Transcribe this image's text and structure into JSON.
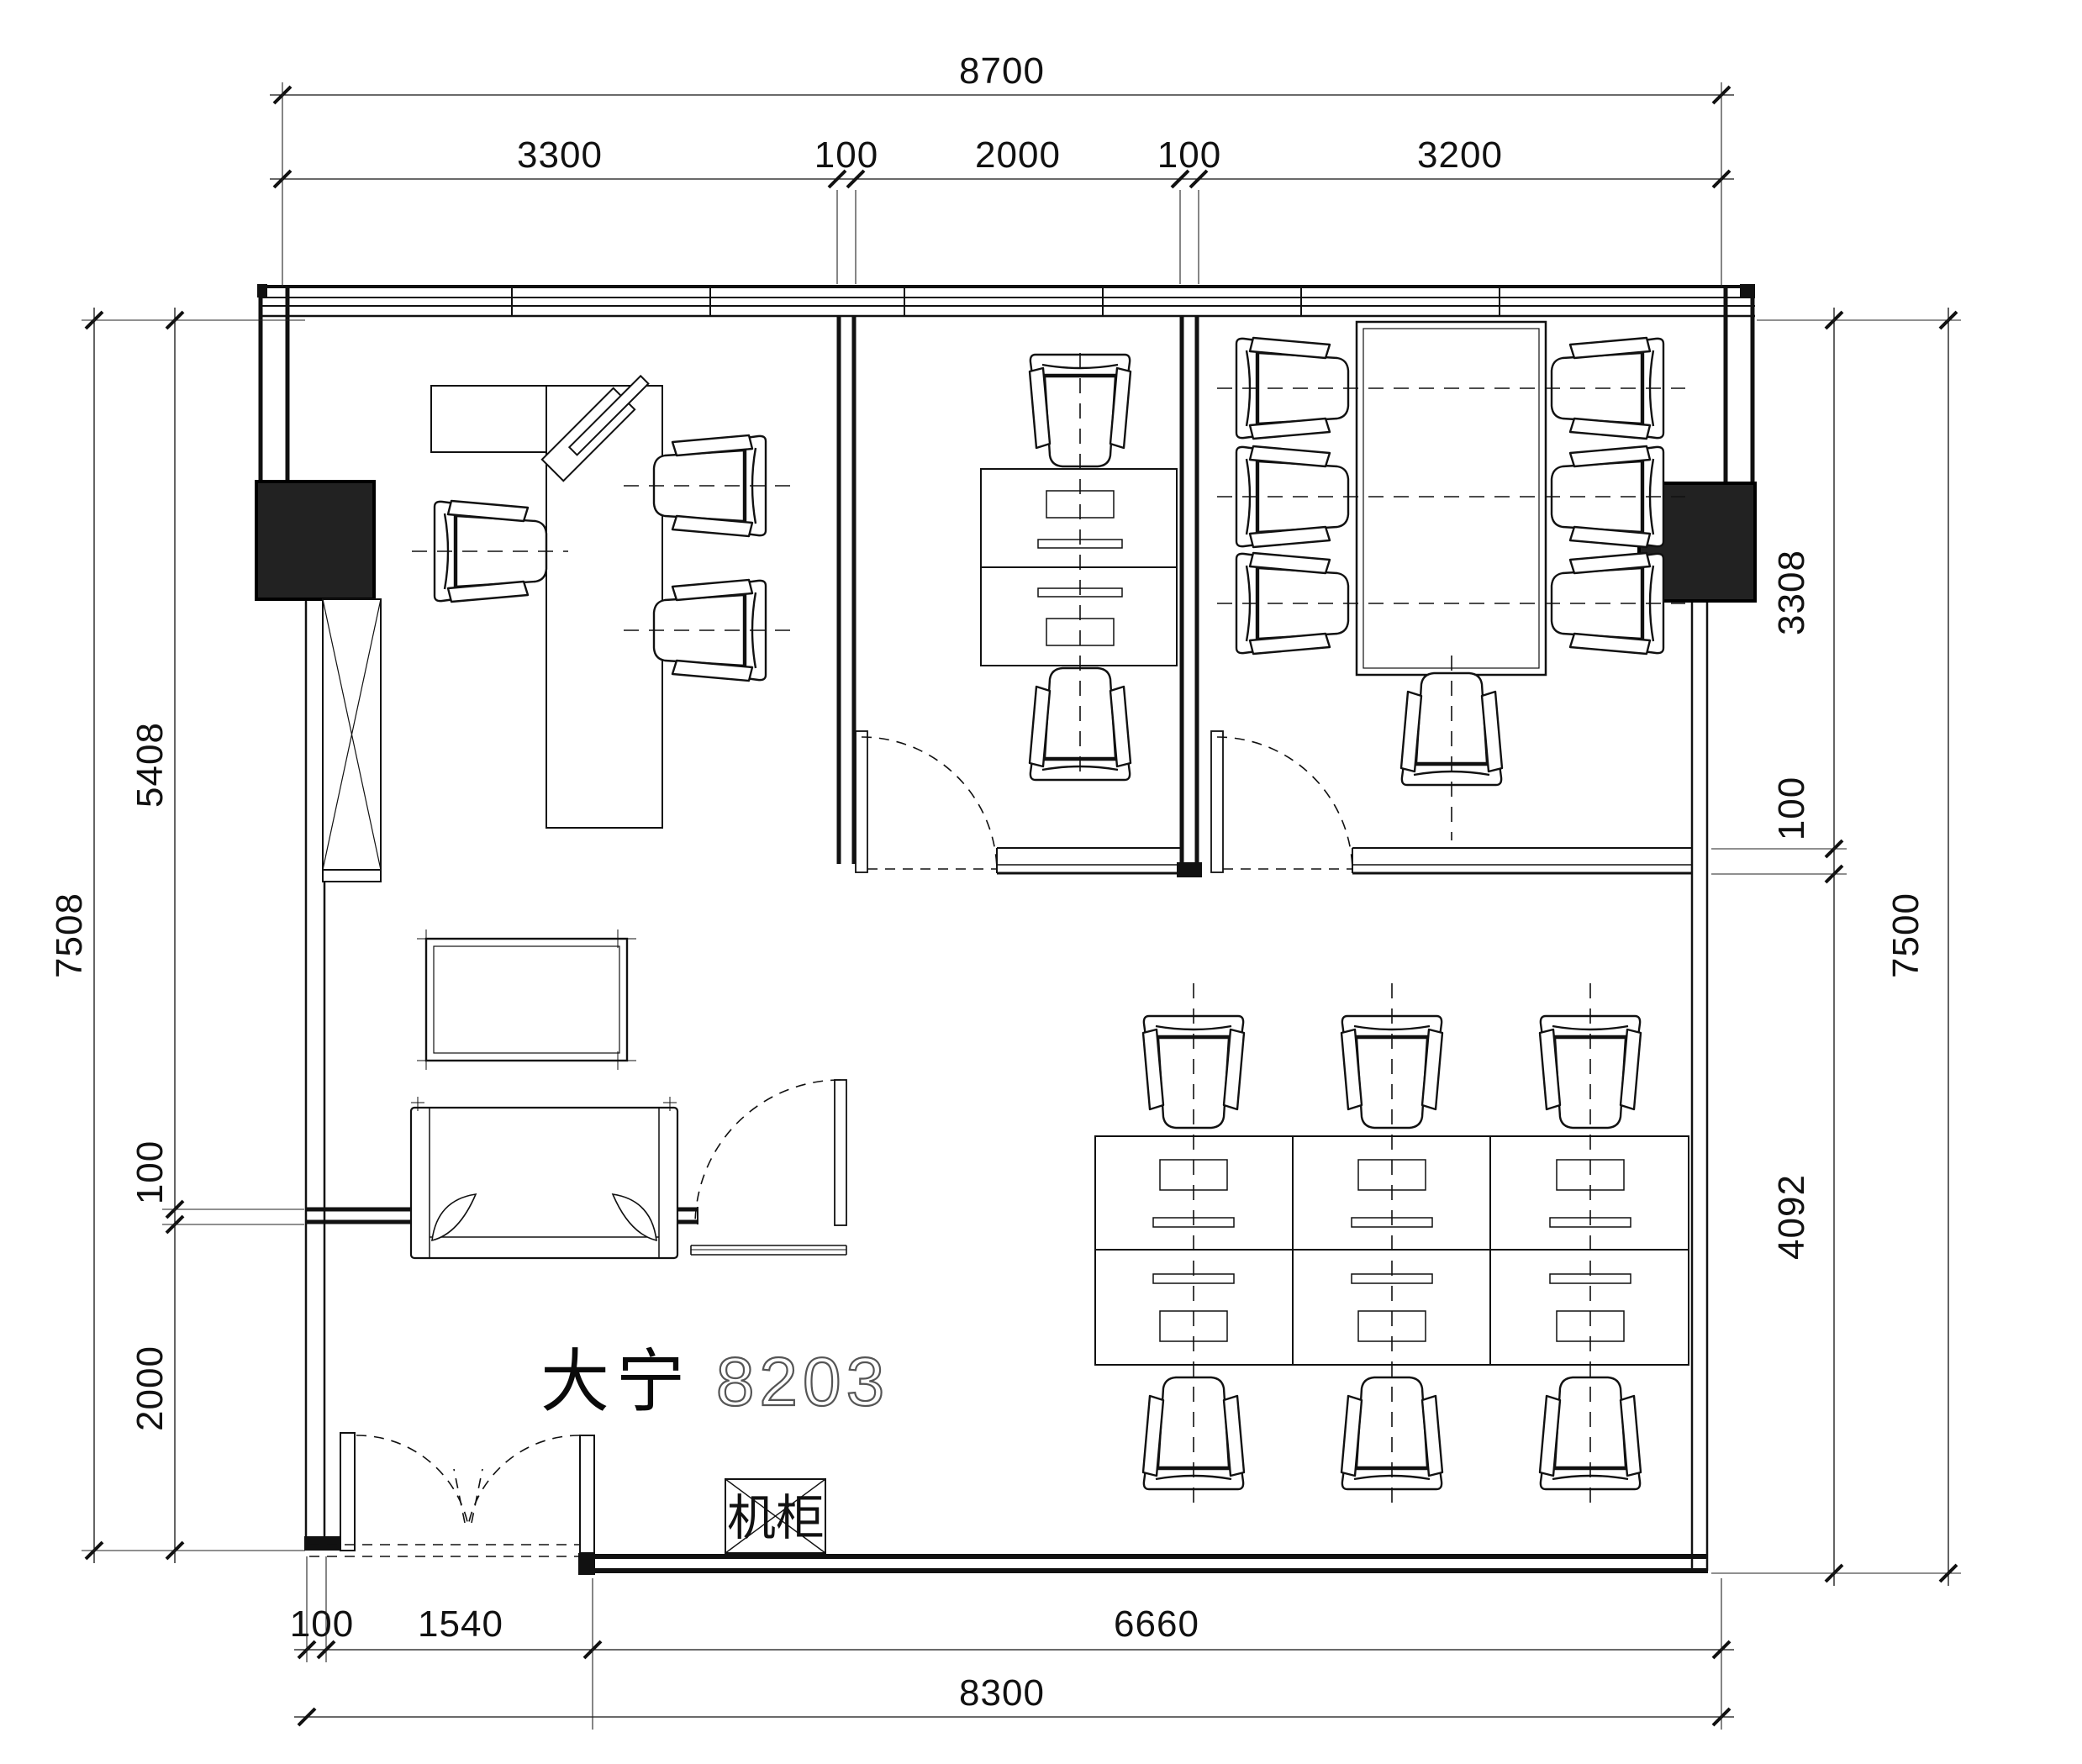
{
  "drawing": {
    "unit_label": {
      "prefix": "大宁",
      "number": "8203"
    },
    "server_cabinet_label": "机柜"
  },
  "dimensions": {
    "top": {
      "total": "8700",
      "segments": [
        "3300",
        "100",
        "2000",
        "100",
        "3200"
      ]
    },
    "left": {
      "total": "7508",
      "segments": [
        "5408",
        "100",
        "2000"
      ]
    },
    "right": {
      "total": "7500",
      "segments": [
        "3308",
        "100",
        "4092"
      ]
    },
    "bottom": {
      "total": "8300",
      "segments": [
        "100",
        "1540",
        "6660"
      ]
    }
  },
  "colors": {
    "line": "#111111",
    "column_fill": "#222222",
    "background": "#ffffff"
  }
}
